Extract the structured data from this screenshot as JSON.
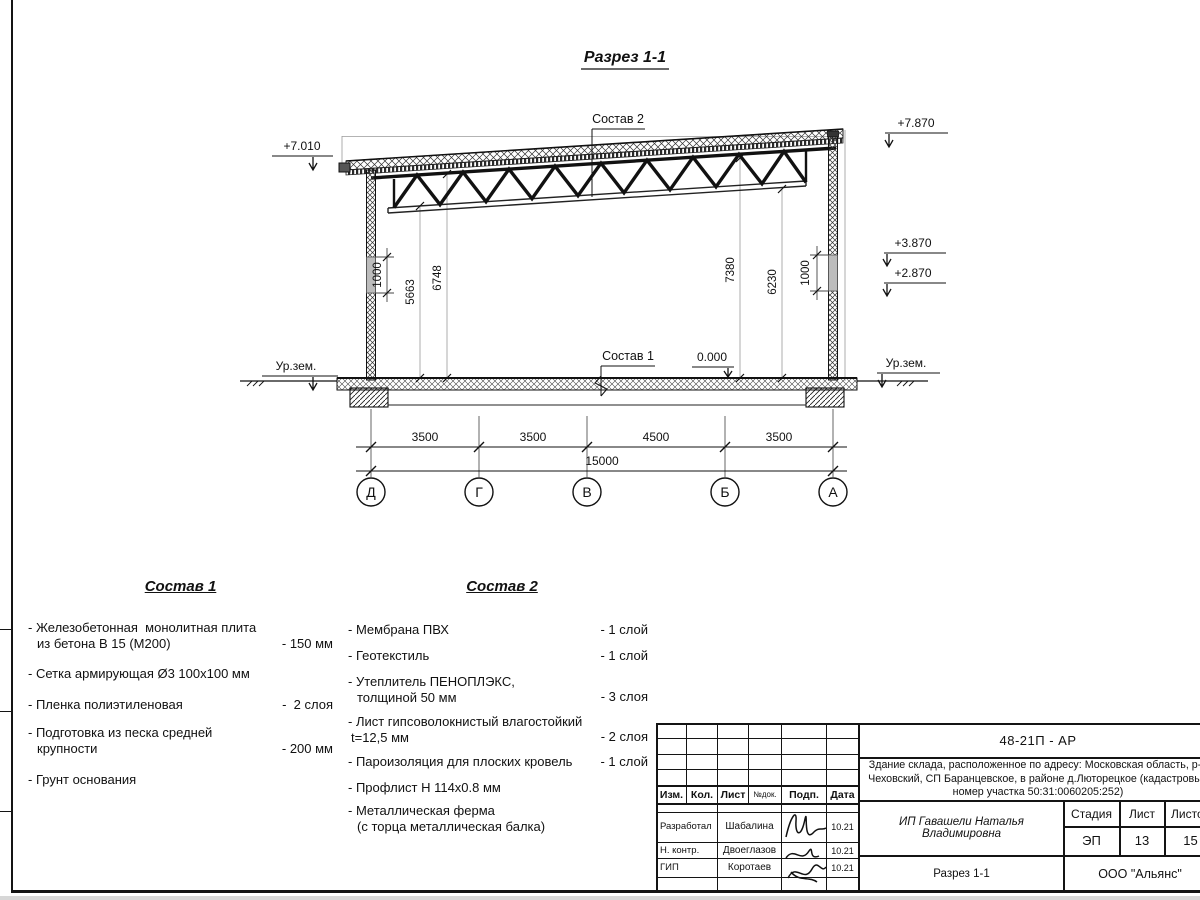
{
  "sheet": {
    "title": "Разрез 1-1",
    "elevations": {
      "roof_left": "+7.010",
      "roof_right": "+7.870",
      "right_upper": "+3.870",
      "right_lower": "+2.870",
      "floor": "0.000",
      "ground_left": "Ур.зем.",
      "ground_right": "Ур.зем."
    },
    "callouts": {
      "roof": "Состав 2",
      "floor": "Состав 1"
    },
    "heights": {
      "parapet_left": "1000",
      "clear_left": "5663",
      "truss_left": "6748",
      "roof_right": "7380",
      "clear_right": "6230",
      "parapet_right": "1000"
    },
    "spans": {
      "d_g": "3500",
      "g_v": "3500",
      "v_b": "4500",
      "b_a": "3500",
      "total": "15000"
    },
    "axes": [
      "Д",
      "Г",
      "В",
      "Б",
      "А"
    ]
  },
  "sostav1": {
    "heading": "Состав 1",
    "items": [
      {
        "line1": "- Железобетонная  монолитная плита",
        "line2": "из бетона В 15 (М200)",
        "value": "- 150 мм"
      },
      {
        "line1": "- Сетка армирующая Ø3 100х100 мм",
        "line2": "",
        "value": ""
      },
      {
        "line1": "- Пленка полиэтиленовая",
        "line2": "",
        "value": "-  2 слоя"
      },
      {
        "line1": "- Подготовка из песка средней",
        "line2": "крупности",
        "value": "- 200 мм"
      },
      {
        "line1": "- Грунт основания",
        "line2": "",
        "value": ""
      }
    ]
  },
  "sostav2": {
    "heading": "Состав 2",
    "items": [
      {
        "line1": "- Мембрана ПВХ",
        "line2": "",
        "value": "- 1 слой"
      },
      {
        "line1": "- Геотекстиль",
        "line2": "",
        "value": "- 1 слой"
      },
      {
        "line1": "- Утеплитель ПЕНОПЛЭКС,",
        "line2": "толщиной 50 мм",
        "value": "- 3 слоя"
      },
      {
        "line1": "- Лист гипсоволокнистый влагостойкий",
        "line2": "t=12,5 мм",
        "value": "- 2 слоя"
      },
      {
        "line1": "- Пароизоляция для плоских кровель",
        "line2": "",
        "value": "- 1 слой"
      },
      {
        "line1": "- Профлист Н 114х0.8 мм",
        "line2": "",
        "value": ""
      },
      {
        "line1": "- Металлическая ферма",
        "line2": "(с торца металлическая балка)",
        "value": ""
      }
    ]
  },
  "titleblock": {
    "code": "48-21П - АР",
    "project_line1": "Здание склада, расположенное по адресу: Московская область, р-н",
    "project_line2": "Чеховский, СП Баранцевское, в районе д.Люторецкое  (кадастровый",
    "project_line3": "номер участка 50:31:0060205:252)",
    "columns": [
      "Изм.",
      "Кол.",
      "Лист",
      "№док.",
      "Подп.",
      "Дата"
    ],
    "rows": [
      {
        "role": "Разработал",
        "name": "Шабалина",
        "date": "10.21"
      },
      {
        "role": "Н. контр.",
        "name": "Двоеглазов",
        "date": "10.21"
      },
      {
        "role": "ГИП",
        "name": "Коротаев",
        "date": "10.21"
      }
    ],
    "client": "ИП Гавашели Наталья Владимировна",
    "stage_label": "Стадия",
    "sheet_label": "Лист",
    "sheets_label": "Листов",
    "stage": "ЭП",
    "sheet": "13",
    "sheets": "15",
    "drawing_name": "Разрез 1-1",
    "company": "ООО \"Альянс\""
  }
}
